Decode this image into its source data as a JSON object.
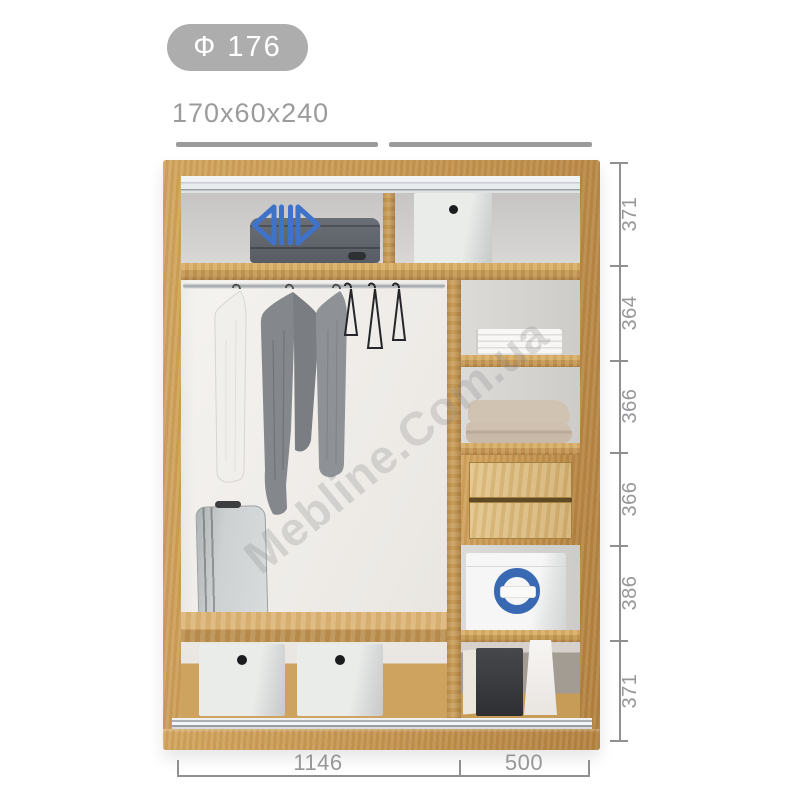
{
  "header": {
    "model_badge": "Ф 176",
    "size_label": "170x60x240"
  },
  "watermark": {
    "text": "Mebline.Com.ua"
  },
  "dims": {
    "vertical": [
      "371",
      "364",
      "366",
      "366",
      "386",
      "371"
    ],
    "horizontal": [
      "1146",
      "500"
    ]
  },
  "icons": {
    "sliding_doors_icon": "two hollow arrows pointing apart (sliding doors)",
    "ring_logo_icon": "blue ring logo on storage box"
  },
  "colors": {
    "wood": "#c9984f",
    "accent_blue": "#3f73c9",
    "dimension_gray": "#97979a",
    "badge_bg": "#adadad",
    "track_bar_gray": "#9b9b9b"
  }
}
